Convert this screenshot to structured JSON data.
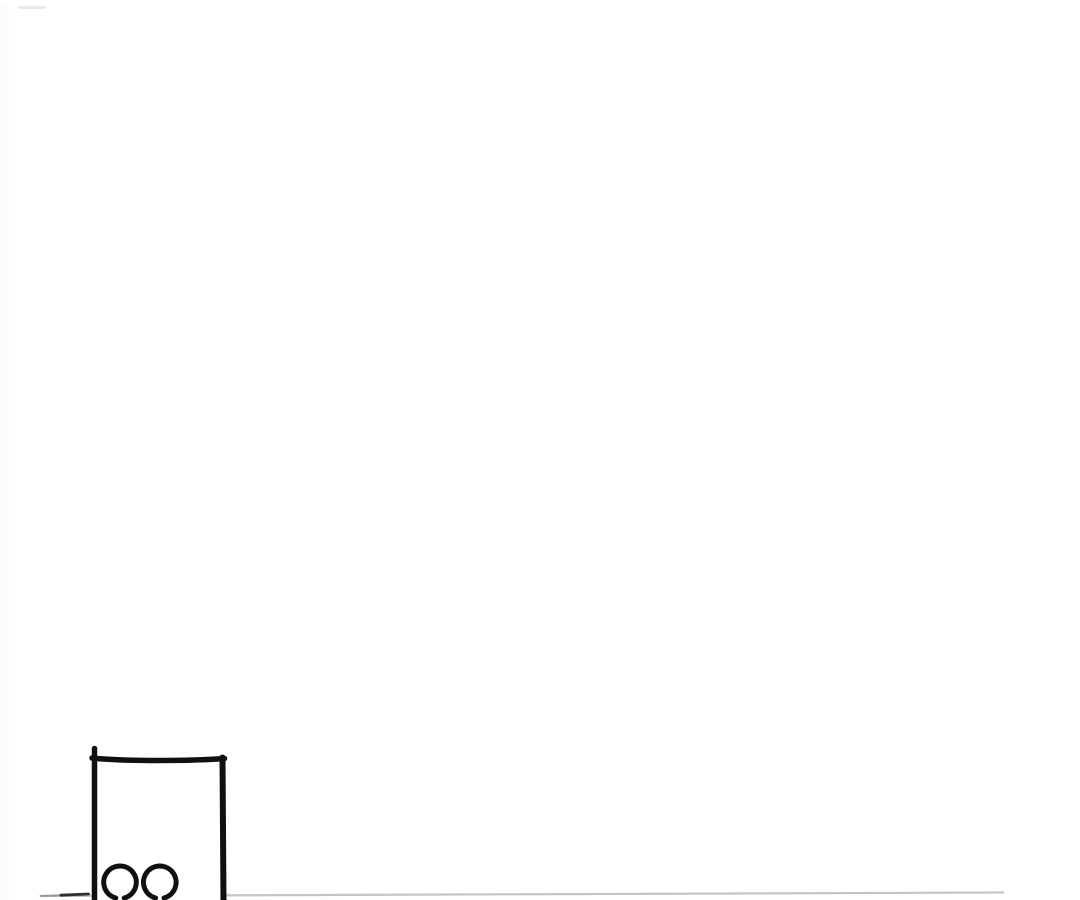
{
  "page": {
    "background": "#ffffff"
  },
  "artwork": {
    "description": "black-and-white comic line art fragment at bottom-left of an otherwise blank white page",
    "ink_color": "#101010",
    "divider_color": "#c4c4c4",
    "smudge_left_color": "#9a9a9a",
    "smudge_right_color": "#2e2e2e",
    "edge_tint_color": "#fbfbfb",
    "streak_color": "#eaeaea"
  }
}
